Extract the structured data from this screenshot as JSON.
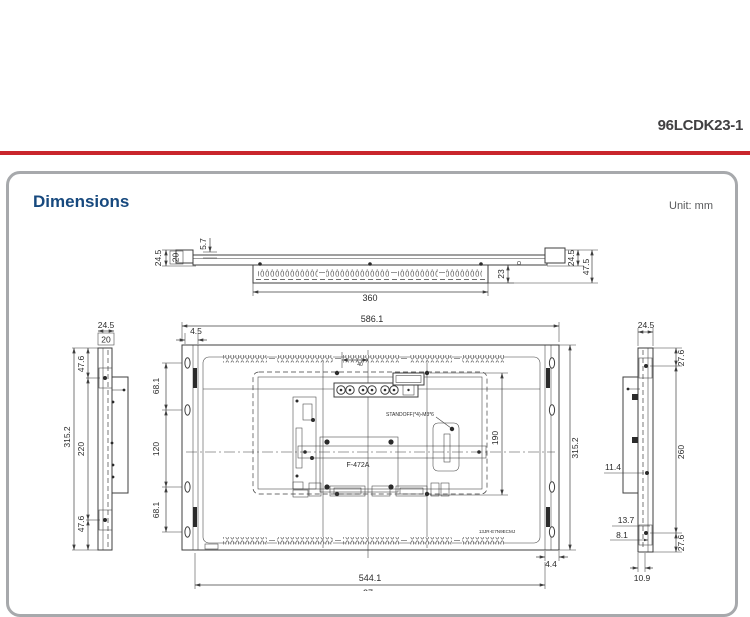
{
  "header": {
    "product_code": "96LCDK23-1"
  },
  "section": {
    "title": "Dimensions",
    "unit": "Unit: mm"
  },
  "colors": {
    "accent_red": "#c9252c",
    "title_blue": "#17497e",
    "panel_border_gray": "#a7a9ac"
  },
  "dims": {
    "top": {
      "lip": "5.7",
      "depth_front_l": "24.5",
      "bracket_l": "20",
      "vent_width": "360",
      "rear_box": "23",
      "depth_front_r": "24.5",
      "depth_total": "47.5"
    },
    "left": {
      "depth_front": "24.5",
      "bracket": "20",
      "edge_to_hole_top": "47.6",
      "height_total": "315.2",
      "hole_span": "220",
      "edge_to_hole_bottom": "47.6"
    },
    "rear": {
      "width_total": "586.1",
      "flange": "4.5",
      "center_offset": "40",
      "hole_span_top": "68.1",
      "hole_span_mid": "120",
      "hole_span_bottom": "68.1",
      "height_total": "315.2",
      "panel_height": "190",
      "flange_right": "4.4",
      "hole_width": "544.1",
      "bottom_partial": "27",
      "board_label": "F-472A",
      "standoff_note": "STANDOFF(*4)-M3*6",
      "module_label": "13JR-E7N9ECMJ"
    },
    "right": {
      "depth_front": "24.5",
      "edge_to_hole_top": "27.6",
      "hole_span": "260",
      "edge_to_hole_bottom": "27.6",
      "inset": "11.4",
      "offset_a": "13.7",
      "offset_b": "8.1",
      "base_width": "10.9"
    }
  }
}
